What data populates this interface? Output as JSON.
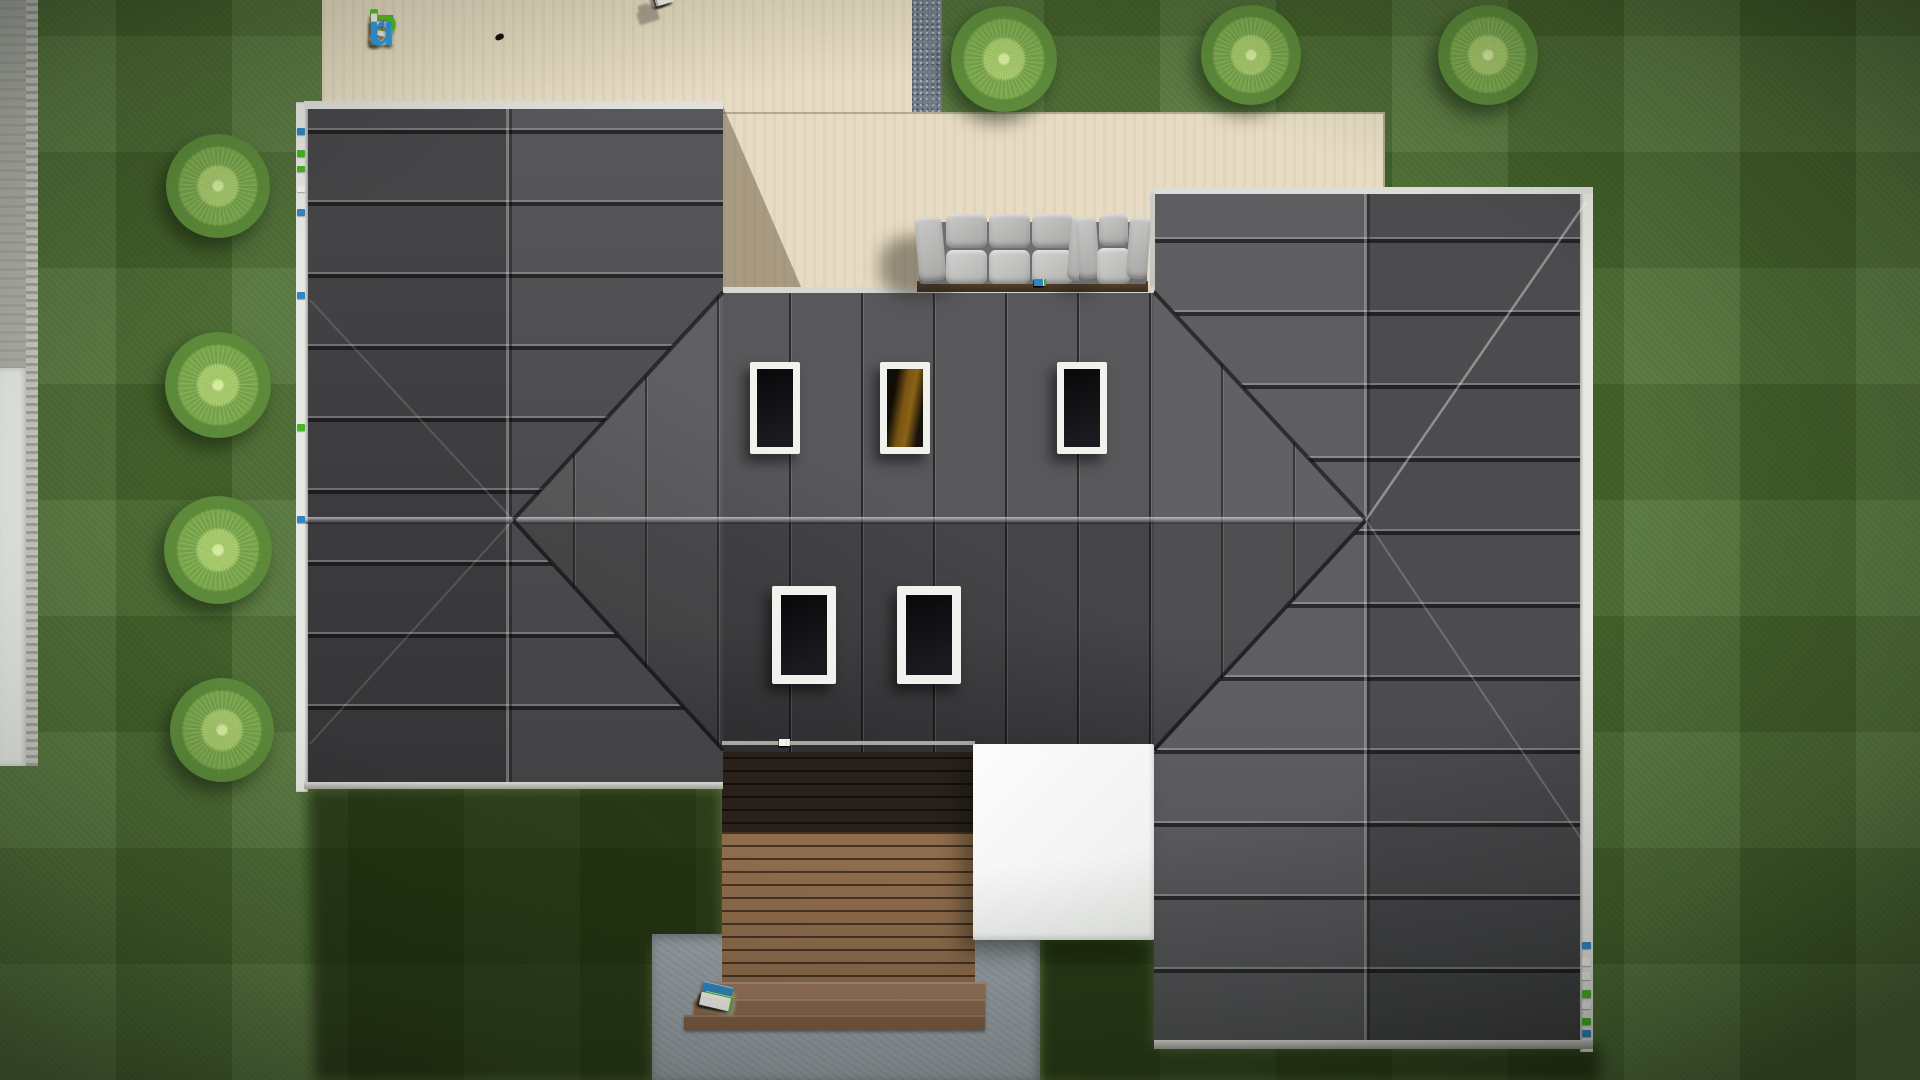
{
  "brand": {
    "name": "FixPlans.ru",
    "letters": [
      {
        "ch": "F",
        "c": "#2f9bdf"
      },
      {
        "ch": "i",
        "c": "#f3f1ea",
        "dot": "#52c41f"
      },
      {
        "ch": "x",
        "c": "#f3f1ea"
      },
      {
        "ch": "P",
        "c": "#52c41f"
      },
      {
        "ch": "l",
        "c": "#f3f1ea"
      },
      {
        "ch": "a",
        "c": "#f3f1ea"
      },
      {
        "ch": "n",
        "c": "#f3f1ea"
      },
      {
        "ch": "s",
        "c": "#f3f1ea"
      },
      {
        "ch": ".",
        "c": "#f3f1ea"
      },
      {
        "ch": "r",
        "c": "#2f9bdf"
      },
      {
        "ch": "u",
        "c": "#2f9bdf"
      }
    ]
  },
  "palette": {
    "w": "#f2f1ea",
    "b": "#2f86c4",
    "g": "#45b522",
    "letter_shadow": "#a09685",
    "roof": "#4a4a4d",
    "grass": "#4e7032",
    "patio": "#e7dcc3",
    "deck": "#8d6b4b",
    "canopy": "#f5f6f5",
    "concrete": "#9aa1a8"
  },
  "scene": {
    "bushes": [
      {
        "x": 218,
        "y": 186,
        "d": 104
      },
      {
        "x": 218,
        "y": 385,
        "d": 106
      },
      {
        "x": 218,
        "y": 550,
        "d": 108
      },
      {
        "x": 222,
        "y": 730,
        "d": 104
      },
      {
        "x": 1004,
        "y": 59,
        "d": 106
      },
      {
        "x": 1251,
        "y": 55,
        "d": 100
      },
      {
        "x": 1488,
        "y": 55,
        "d": 100
      }
    ],
    "skylights": [
      {
        "x": 750,
        "y": 362,
        "w": 50,
        "h": 92,
        "f": 7,
        "amber": false
      },
      {
        "x": 880,
        "y": 362,
        "w": 50,
        "h": 92,
        "f": 7,
        "amber": true
      },
      {
        "x": 1057,
        "y": 362,
        "w": 50,
        "h": 92,
        "f": 7,
        "amber": false
      },
      {
        "x": 772,
        "y": 586,
        "w": 64,
        "h": 98,
        "f": 9,
        "amber": false
      },
      {
        "x": 897,
        "y": 586,
        "w": 64,
        "h": 98,
        "f": 9,
        "amber": false
      }
    ],
    "strips": [
      {
        "x": 1032,
        "y": 286,
        "blocks": [
          {
            "w": 10,
            "h": 7,
            "c": "w"
          },
          {
            "w": 8,
            "h": 7,
            "c": "w"
          },
          {
            "w": 6,
            "h": 7,
            "c": "b"
          },
          {
            "w": 10,
            "h": 7,
            "c": "w"
          },
          {
            "w": 9,
            "h": 7,
            "c": "w"
          },
          {
            "w": 9,
            "h": 7,
            "c": "w"
          },
          {
            "w": 5,
            "h": 7,
            "c": "w"
          },
          {
            "w": 12,
            "h": 7,
            "c": "g"
          },
          {
            "w": 10,
            "h": 7,
            "c": "w"
          },
          {
            "w": 5,
            "h": 7,
            "c": "g"
          },
          {
            "w": 9,
            "h": 7,
            "c": "b"
          }
        ]
      },
      {
        "x": 777,
        "y": 746,
        "blocks": [
          {
            "w": 6,
            "h": 7,
            "c": "b"
          },
          {
            "w": 9,
            "h": 7,
            "c": "w"
          },
          {
            "w": 7,
            "h": 7,
            "c": "g"
          },
          {
            "w": 11,
            "h": 7,
            "c": "w"
          },
          {
            "w": 9,
            "h": 7,
            "c": "w"
          },
          {
            "w": 4,
            "h": 7,
            "c": "w"
          },
          {
            "w": 10,
            "h": 7,
            "c": "w"
          },
          {
            "w": 7,
            "h": 7,
            "c": "w"
          }
        ]
      }
    ],
    "gutter_dots": [
      {
        "x": 297,
        "y": 128,
        "w": 8,
        "h": 7,
        "c": "b"
      },
      {
        "x": 297,
        "y": 150,
        "w": 8,
        "h": 7,
        "c": "g"
      },
      {
        "x": 297,
        "y": 166,
        "w": 8,
        "h": 6,
        "c": "g"
      },
      {
        "x": 297,
        "y": 186,
        "w": 8,
        "h": 6,
        "c": "w"
      },
      {
        "x": 297,
        "y": 209,
        "w": 8,
        "h": 7,
        "c": "b"
      },
      {
        "x": 297,
        "y": 292,
        "w": 8,
        "h": 7,
        "c": "b"
      },
      {
        "x": 297,
        "y": 424,
        "w": 8,
        "h": 7,
        "c": "g"
      },
      {
        "x": 297,
        "y": 516,
        "w": 8,
        "h": 7,
        "c": "b"
      },
      {
        "x": 1582,
        "y": 942,
        "w": 9,
        "h": 7,
        "c": "b"
      },
      {
        "x": 1582,
        "y": 958,
        "w": 9,
        "h": 8,
        "c": "w"
      },
      {
        "x": 1582,
        "y": 972,
        "w": 9,
        "h": 8,
        "c": "w"
      },
      {
        "x": 1582,
        "y": 990,
        "w": 9,
        "h": 8,
        "c": "g"
      },
      {
        "x": 1582,
        "y": 1002,
        "w": 9,
        "h": 7,
        "c": "w"
      },
      {
        "x": 1582,
        "y": 1018,
        "w": 9,
        "h": 7,
        "c": "g"
      },
      {
        "x": 1582,
        "y": 1030,
        "w": 9,
        "h": 7,
        "c": "b"
      }
    ],
    "letters3d_top": {
      "x": 652,
      "y": 8,
      "rot": -17,
      "sdx": -14,
      "sdy": 18,
      "blocks": [
        {
          "w": 20,
          "h": 13,
          "c": "w"
        },
        {
          "w": 8,
          "h": 17,
          "c": "w",
          "g": 5
        },
        {
          "w": 12,
          "h": 12,
          "c": "b",
          "g": 5
        },
        {
          "w": 18,
          "h": 15,
          "c": "w",
          "g": 5
        },
        {
          "w": 9,
          "h": 19,
          "c": "w",
          "g": 7
        },
        {
          "w": 16,
          "h": 17,
          "c": "w",
          "g": 5
        },
        {
          "w": 9,
          "h": 19,
          "c": "w",
          "g": 5
        },
        {
          "w": 14,
          "h": 15,
          "c": "w",
          "g": 7
        }
      ]
    },
    "letters3d_bottom": {
      "x": 697,
      "y": 1004,
      "rot": 13,
      "sdx": 3,
      "sdy": 5,
      "blocks": [
        {
          "w": 30,
          "h": 24,
          "c": "b"
        },
        {
          "w": 13,
          "h": 13,
          "c": "g",
          "g": 10
        },
        {
          "w": 24,
          "h": 13,
          "c": "w",
          "g": 2
        },
        {
          "w": 28,
          "h": 15,
          "c": "g",
          "g": 6
        },
        {
          "w": 9,
          "h": 11,
          "c": "w",
          "g": 5
        },
        {
          "w": 30,
          "h": 13,
          "c": "w",
          "g": 2
        },
        {
          "w": 27,
          "h": 13,
          "c": "w",
          "g": 4
        },
        {
          "w": 8,
          "h": 10,
          "c": "w",
          "g": 4
        },
        {
          "w": 24,
          "h": 12,
          "c": "w",
          "g": 2
        },
        {
          "w": 11,
          "h": 11,
          "c": "b",
          "g": 4
        },
        {
          "w": 22,
          "h": 11,
          "c": "w",
          "g": 4
        },
        {
          "w": 24,
          "h": 11,
          "c": "w",
          "g": 2
        }
      ]
    }
  }
}
